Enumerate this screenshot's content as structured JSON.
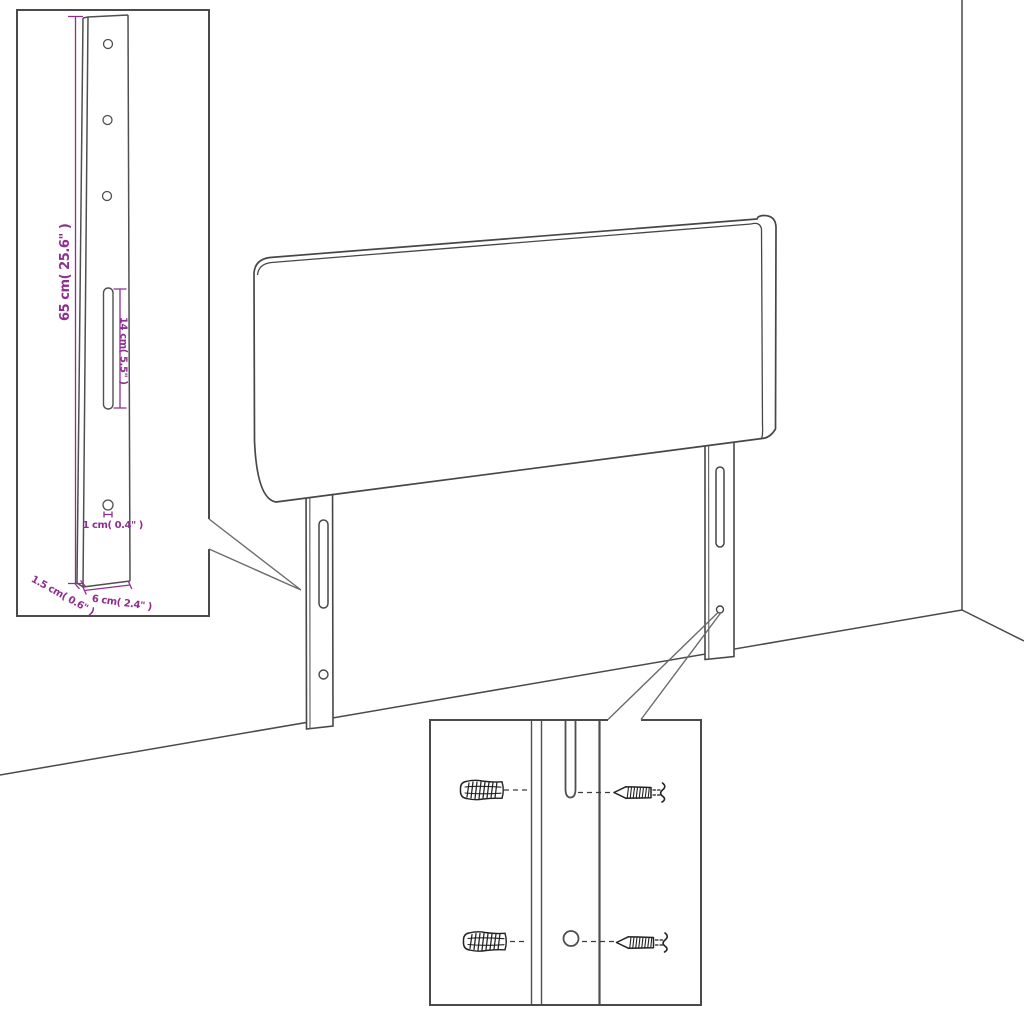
{
  "colors": {
    "accent": "#8e2f8f",
    "line": "#474747",
    "leader": "#6b6b6b",
    "hardware": "#222222",
    "background": "#ffffff"
  },
  "insets": {
    "leg_detail": {
      "labels": {
        "height": "65 cm( 25.6\" )",
        "slot": "14 cm( 5.5\" )",
        "hole": "1 cm( 0.4\" )",
        "thickness": "1.5 cm( 0.6\" )",
        "width": "6 cm( 2.4\" )"
      }
    },
    "mounting_detail": {
      "hardware_icons": [
        "wall-plug-icon",
        "screw-icon",
        "wall-plug-icon",
        "screw-icon"
      ]
    }
  }
}
